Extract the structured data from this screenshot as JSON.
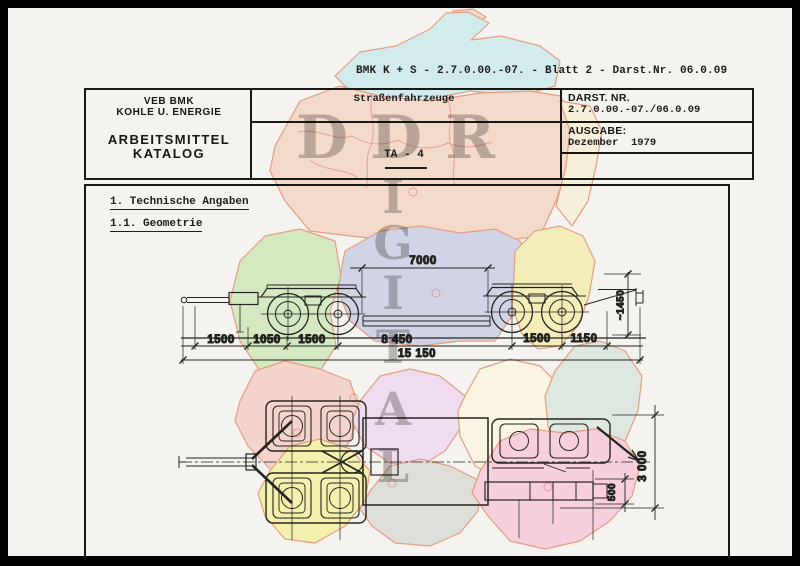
{
  "document": {
    "reference_line": "BMK K + S - 2.7.0.00.-07. - Blatt 2 - Darst.Nr. 06.0.09",
    "header": {
      "org_line1": "VEB BMK",
      "org_line2": "KOHLE U. ENERGIE",
      "catalog_line1": "ARBEITSMITTEL",
      "catalog_line2": "KATALOG",
      "category": "Straßenfahrzeuge",
      "type_code": "TA - 4",
      "darst_label": "DARST. NR.",
      "darst_value": "2.7.0.00.-07./06.0.09",
      "ausgabe_label": "AUSGABE:",
      "ausgabe_value": "Dezember  1979"
    },
    "sections": {
      "heading1": "1. Technische Angaben",
      "heading2": "1.1. Geometrie"
    },
    "dimensions": {
      "top_length": "7000",
      "segments": [
        "1500",
        "1050",
        "1500",
        "8 450",
        "1500",
        "1150"
      ],
      "total_length": "15 150",
      "height": "~1450",
      "width": "3 000",
      "offset": "500"
    }
  },
  "watermark": {
    "horizontal": [
      "D",
      "D",
      "R"
    ],
    "vertical": [
      "I",
      "G",
      "I",
      "T",
      "A",
      "L"
    ],
    "color": "#8f8f8b"
  },
  "map": {
    "colors": {
      "rostock": "#cdebee",
      "ruegen": "#f3d7c9",
      "north": "#f5d6c5",
      "northeast": "#f7f0d8",
      "west_green": "#cfe8ba",
      "mid_lavender": "#cbcfe6",
      "east_yellow": "#f3ecb0",
      "halle_pink": "#f4cfc6",
      "erfurt_yellow": "#f4f0a2",
      "mid_violet": "#efd9ee",
      "cream": "#faf6e0",
      "gera_gray": "#dbdbd7",
      "south_pink": "#f8c9db",
      "cottbus_gray": "#dce5df",
      "outline": "#e2906e",
      "district_border": "#e07878"
    }
  }
}
